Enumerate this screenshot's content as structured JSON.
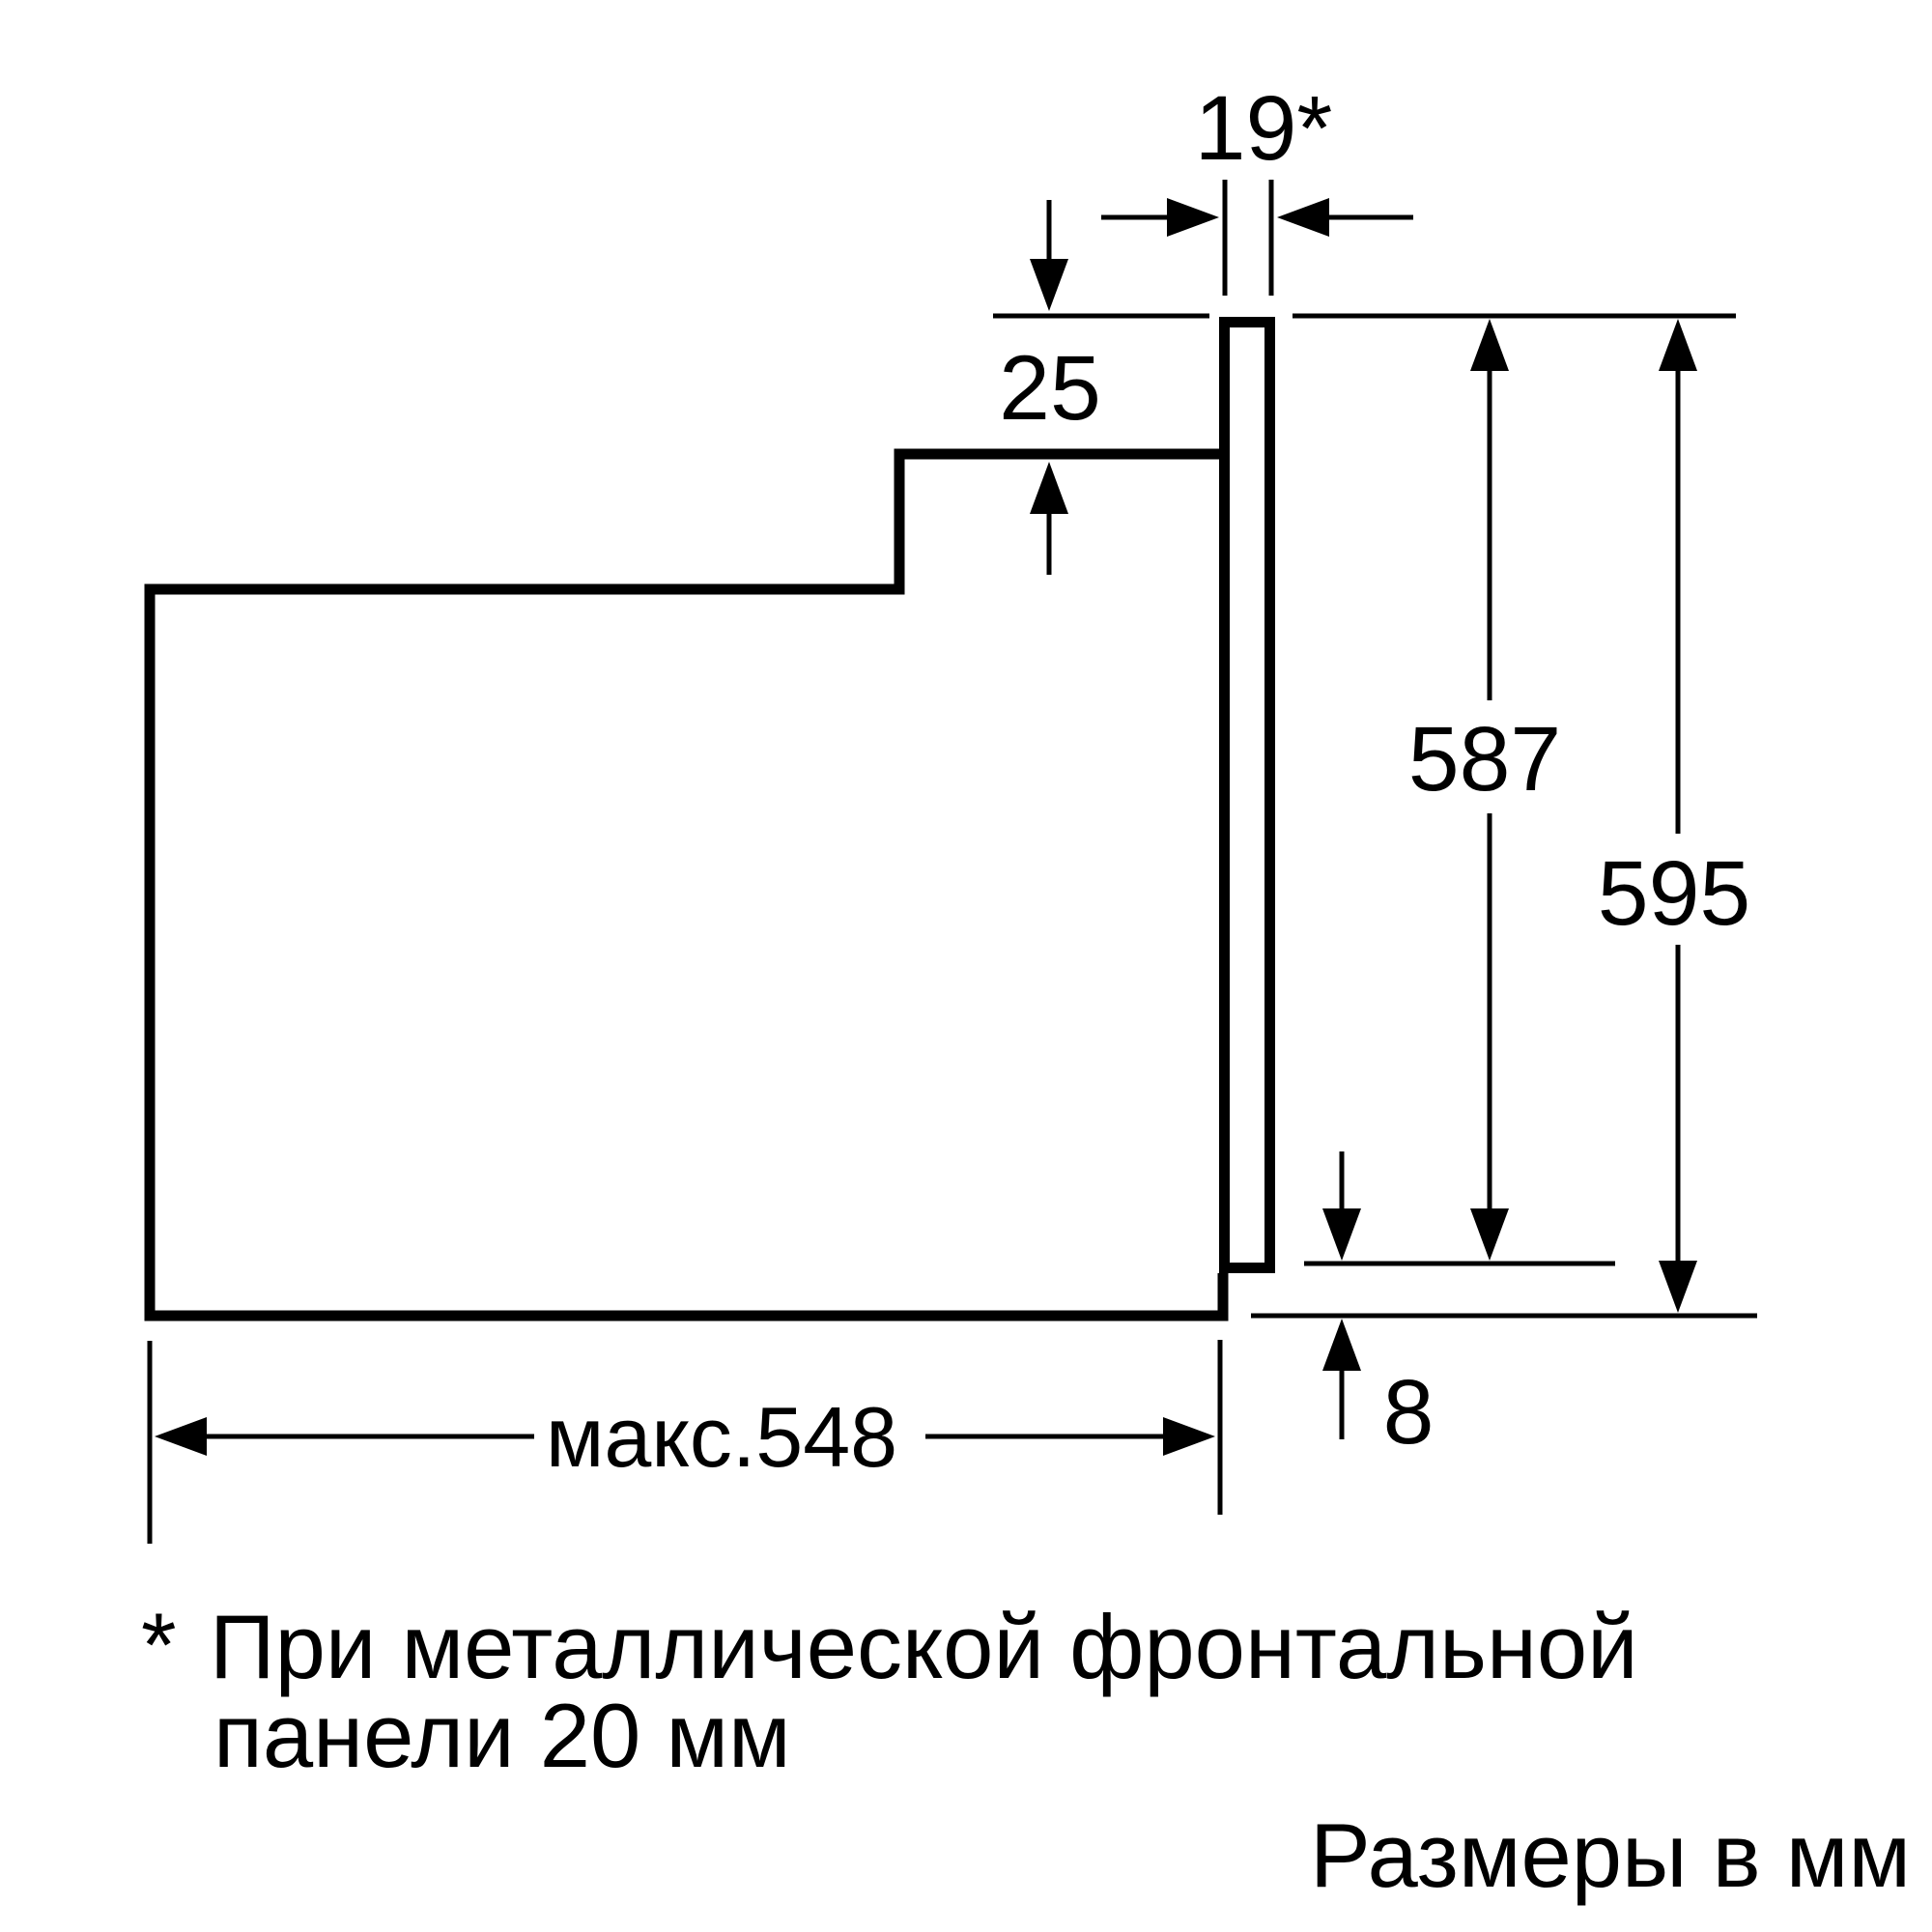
{
  "figure": {
    "kind": "oven-installation-dimension-drawing",
    "units_label": "Размеры в мм"
  },
  "dimensions": {
    "top_gap": "19*",
    "step_height": "25",
    "niche_height": "587",
    "total_height": "595",
    "bottom_gap": "8",
    "max_depth": "макс.548"
  },
  "footnote": {
    "marker": "*",
    "line1": "При металлической фронтальной",
    "line2": "панели 20 мм"
  },
  "colors": {
    "line": "#000000",
    "background": "#ffffff"
  }
}
